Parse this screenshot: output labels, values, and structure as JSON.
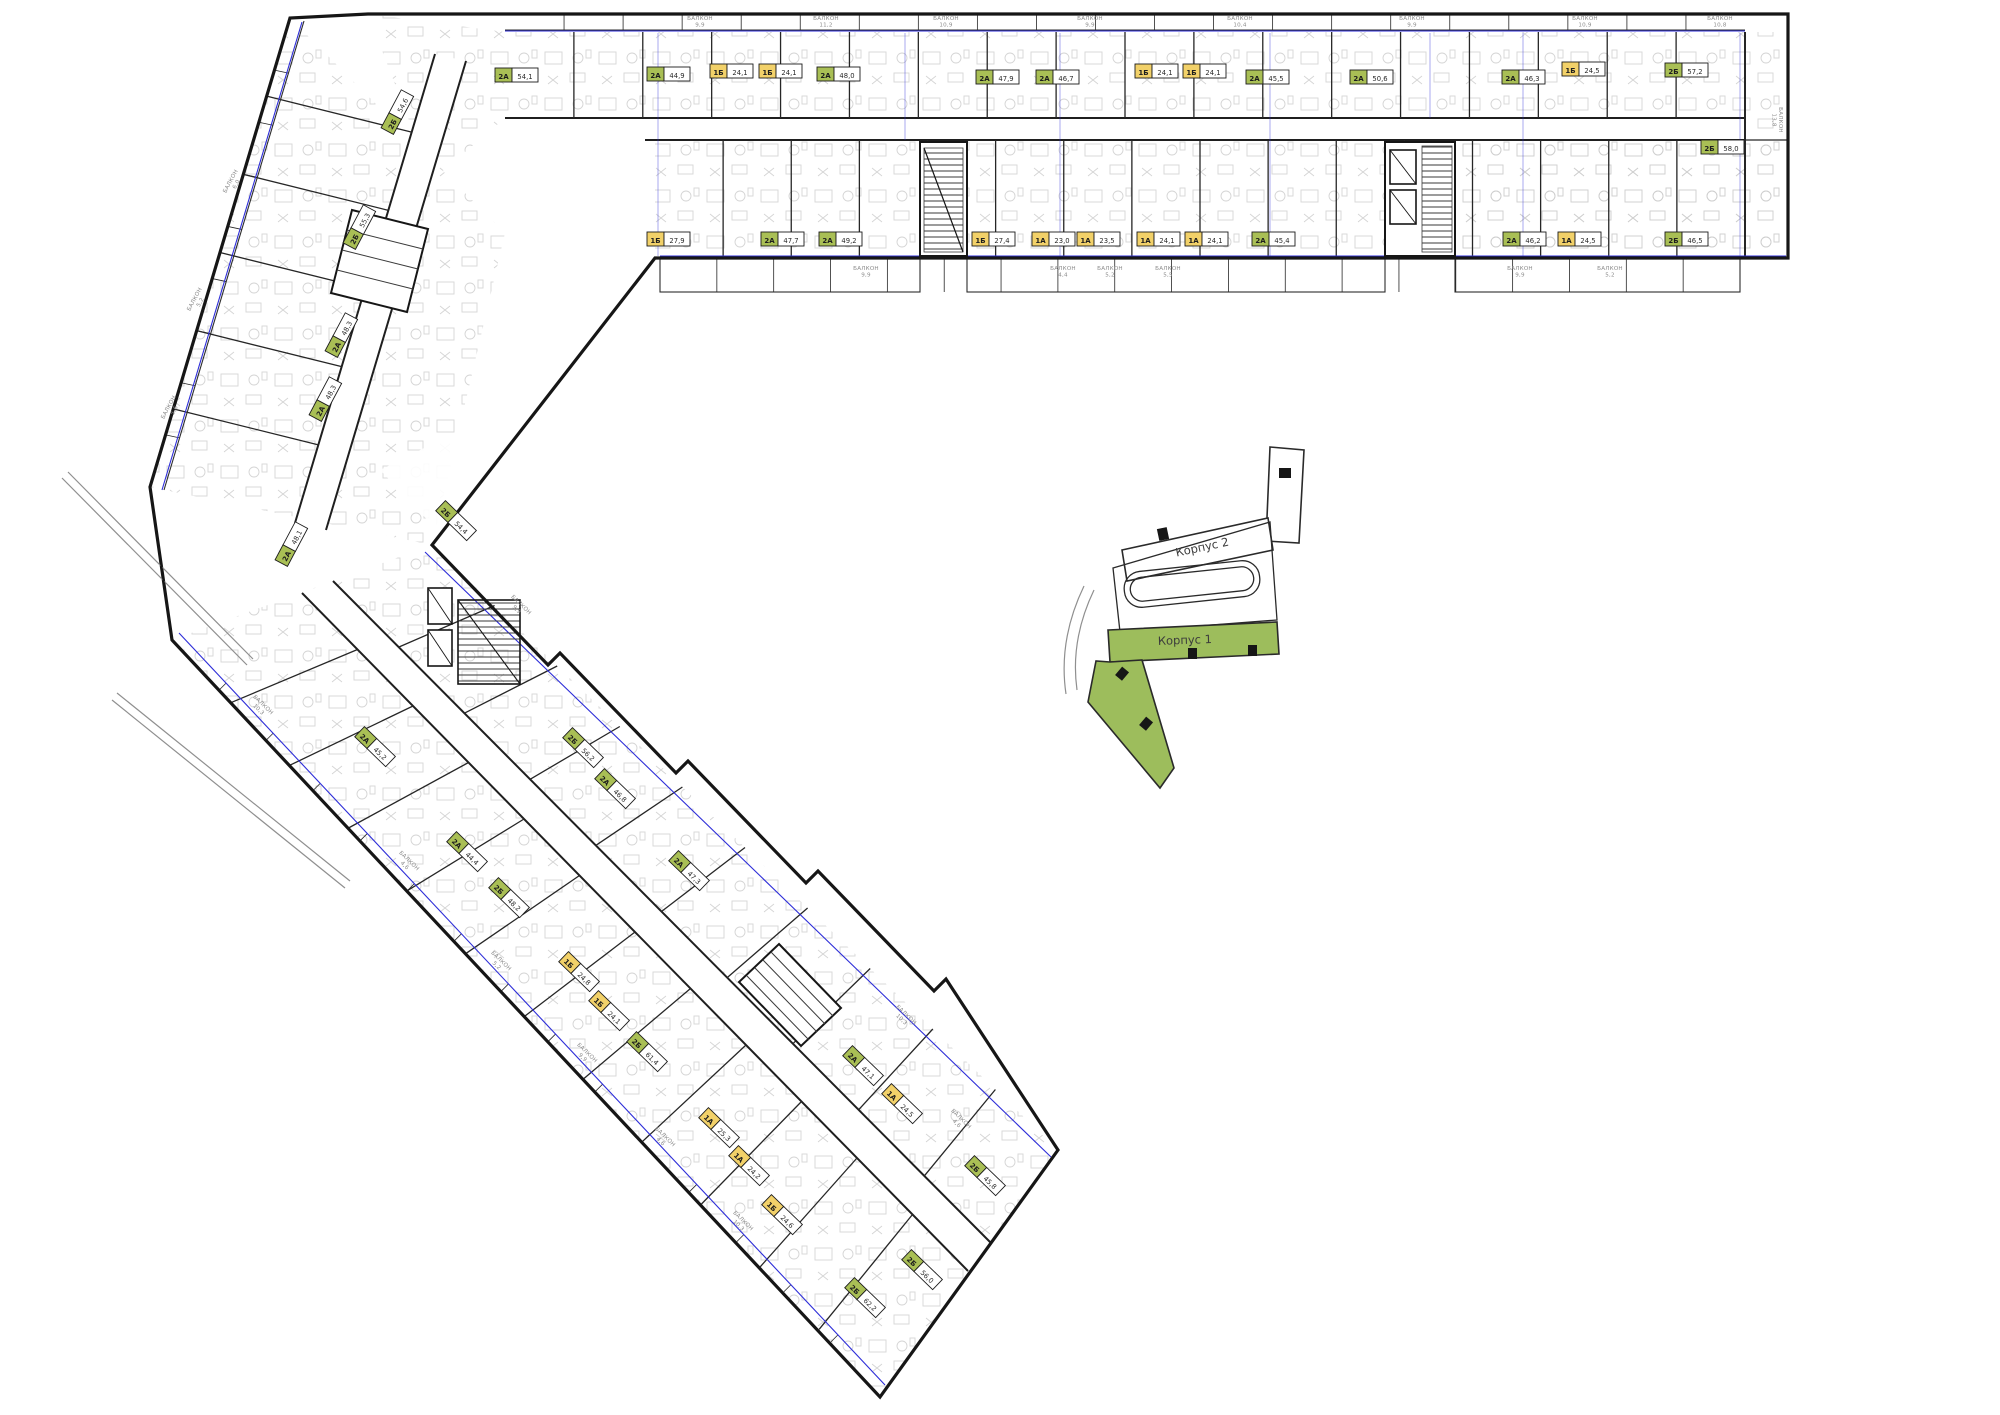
{
  "page": {
    "background": "#ffffff"
  },
  "colors": {
    "wall": "#161616",
    "detail_gray": "#9a9a9a",
    "window_blue": "#2d2dd8",
    "label_green": "#a9bf55",
    "label_yellow": "#f2d169",
    "label_border": "#1c1c1c",
    "keyplan_green": "#9dbd5c",
    "keyplan_wall": "#2a2a2a"
  },
  "key_plan": {
    "building1_label": "Корпус 1",
    "building2_label": "Корпус 2"
  },
  "plan": {
    "balcony_word": "БАЛКОН",
    "units": [
      {
        "t": "2А",
        "a": "54,1",
        "x": 516,
        "y": 76,
        "r": 0
      },
      {
        "t": "2А",
        "a": "44,9",
        "x": 668,
        "y": 75,
        "r": 0
      },
      {
        "t": "1Б",
        "a": "24,1",
        "x": 731,
        "y": 72,
        "r": 0
      },
      {
        "t": "1Б",
        "a": "24,1",
        "x": 780,
        "y": 72,
        "r": 0
      },
      {
        "t": "2А",
        "a": "48,0",
        "x": 838,
        "y": 75,
        "r": 0
      },
      {
        "t": "2А",
        "a": "47,9",
        "x": 997,
        "y": 78,
        "r": 0
      },
      {
        "t": "2А",
        "a": "46,7",
        "x": 1057,
        "y": 78,
        "r": 0
      },
      {
        "t": "1Б",
        "a": "24,1",
        "x": 1156,
        "y": 72,
        "r": 0
      },
      {
        "t": "1Б",
        "a": "24,1",
        "x": 1204,
        "y": 72,
        "r": 0
      },
      {
        "t": "2А",
        "a": "45,5",
        "x": 1267,
        "y": 78,
        "r": 0
      },
      {
        "t": "2А",
        "a": "50,6",
        "x": 1371,
        "y": 78,
        "r": 0
      },
      {
        "t": "2А",
        "a": "46,3",
        "x": 1523,
        "y": 78,
        "r": 0
      },
      {
        "t": "1Б",
        "a": "24,5",
        "x": 1583,
        "y": 70,
        "r": 0
      },
      {
        "t": "2Б",
        "a": "57,2",
        "x": 1686,
        "y": 71,
        "r": 0
      },
      {
        "t": "2Б",
        "a": "58,0",
        "x": 1722,
        "y": 148,
        "r": 0
      },
      {
        "t": "1Б",
        "a": "27,9",
        "x": 668,
        "y": 240,
        "r": 0
      },
      {
        "t": "2А",
        "a": "47,7",
        "x": 782,
        "y": 240,
        "r": 0
      },
      {
        "t": "2А",
        "a": "49,2",
        "x": 840,
        "y": 240,
        "r": 0
      },
      {
        "t": "1Б",
        "a": "27,4",
        "x": 993,
        "y": 240,
        "r": 0
      },
      {
        "t": "1А",
        "a": "23,0",
        "x": 1053,
        "y": 240,
        "r": 0
      },
      {
        "t": "1А",
        "a": "23,5",
        "x": 1098,
        "y": 240,
        "r": 0
      },
      {
        "t": "1А",
        "a": "24,1",
        "x": 1158,
        "y": 240,
        "r": 0
      },
      {
        "t": "1А",
        "a": "24,1",
        "x": 1206,
        "y": 240,
        "r": 0
      },
      {
        "t": "2А",
        "a": "45,4",
        "x": 1273,
        "y": 240,
        "r": 0
      },
      {
        "t": "2А",
        "a": "46,2",
        "x": 1524,
        "y": 240,
        "r": 0
      },
      {
        "t": "1А",
        "a": "24,5",
        "x": 1579,
        "y": 240,
        "r": 0
      },
      {
        "t": "2Б",
        "a": "46,5",
        "x": 1686,
        "y": 240,
        "r": 0
      },
      {
        "t": "2Б",
        "a": "54,6",
        "x": 398,
        "y": 113,
        "r": -62
      },
      {
        "t": "2Б",
        "a": "55,3",
        "x": 360,
        "y": 228,
        "r": -62
      },
      {
        "t": "2А",
        "a": "48,3",
        "x": 342,
        "y": 336,
        "r": -62
      },
      {
        "t": "2А",
        "a": "48,3",
        "x": 326,
        "y": 400,
        "r": -62
      },
      {
        "t": "2А",
        "a": "48,1",
        "x": 292,
        "y": 545,
        "r": -62
      },
      {
        "t": "2Б",
        "a": "54,4",
        "x": 455,
        "y": 521,
        "r": 44
      },
      {
        "t": "2Б",
        "a": "56,2",
        "x": 582,
        "y": 748,
        "r": 44
      },
      {
        "t": "2А",
        "a": "46,8",
        "x": 614,
        "y": 789,
        "r": 44
      },
      {
        "t": "2А",
        "a": "47,3",
        "x": 688,
        "y": 871,
        "r": 44
      },
      {
        "t": "2А",
        "a": "47,1",
        "x": 862,
        "y": 1066,
        "r": 44
      },
      {
        "t": "1А",
        "a": "24,5",
        "x": 901,
        "y": 1104,
        "r": 44
      },
      {
        "t": "2Б",
        "a": "45,8",
        "x": 984,
        "y": 1176,
        "r": 44
      },
      {
        "t": "2Б",
        "a": "56,0",
        "x": 921,
        "y": 1270,
        "r": 44
      },
      {
        "t": "2А",
        "a": "45,2",
        "x": 374,
        "y": 747,
        "r": 44
      },
      {
        "t": "2А",
        "a": "44,4",
        "x": 466,
        "y": 852,
        "r": 44
      },
      {
        "t": "2Б",
        "a": "48,2",
        "x": 508,
        "y": 898,
        "r": 44
      },
      {
        "t": "1Б",
        "a": "24,8",
        "x": 578,
        "y": 972,
        "r": 44
      },
      {
        "t": "1Б",
        "a": "24,1",
        "x": 608,
        "y": 1011,
        "r": 44
      },
      {
        "t": "2Б",
        "a": "61,4",
        "x": 646,
        "y": 1052,
        "r": 44
      },
      {
        "t": "1А",
        "a": "25,3",
        "x": 718,
        "y": 1128,
        "r": 44
      },
      {
        "t": "1А",
        "a": "24,2",
        "x": 748,
        "y": 1166,
        "r": 44
      },
      {
        "t": "1Б",
        "a": "24,6",
        "x": 781,
        "y": 1215,
        "r": 44
      },
      {
        "t": "2Б",
        "a": "62,2",
        "x": 864,
        "y": 1298,
        "r": 44
      }
    ],
    "balconies": [
      {
        "v": "9,9",
        "x": 700,
        "y": 20,
        "r": 0
      },
      {
        "v": "11,2",
        "x": 826,
        "y": 20,
        "r": 0
      },
      {
        "v": "10,9",
        "x": 946,
        "y": 20,
        "r": 0
      },
      {
        "v": "9,9",
        "x": 1090,
        "y": 20,
        "r": 0
      },
      {
        "v": "10,4",
        "x": 1240,
        "y": 20,
        "r": 0
      },
      {
        "v": "9,9",
        "x": 1412,
        "y": 20,
        "r": 0
      },
      {
        "v": "10,9",
        "x": 1585,
        "y": 20,
        "r": 0
      },
      {
        "v": "10,8",
        "x": 1720,
        "y": 20,
        "r": 0
      },
      {
        "v": "9,9",
        "x": 866,
        "y": 270,
        "r": 0
      },
      {
        "v": "4,4",
        "x": 1063,
        "y": 270,
        "r": 0
      },
      {
        "v": "5,2",
        "x": 1110,
        "y": 270,
        "r": 0
      },
      {
        "v": "5,5",
        "x": 1168,
        "y": 270,
        "r": 0
      },
      {
        "v": "9,9",
        "x": 1520,
        "y": 270,
        "r": 0
      },
      {
        "v": "5,2",
        "x": 1610,
        "y": 270,
        "r": 0
      },
      {
        "v": "13,8",
        "x": 1779,
        "y": 120,
        "r": 90
      },
      {
        "v": "6,0",
        "x": 232,
        "y": 182,
        "r": -62
      },
      {
        "v": "5,2",
        "x": 196,
        "y": 300,
        "r": -62
      },
      {
        "v": "5,6",
        "x": 170,
        "y": 408,
        "r": -62
      },
      {
        "v": "10,3",
        "x": 262,
        "y": 706,
        "r": 44
      },
      {
        "v": "4,6",
        "x": 408,
        "y": 862,
        "r": 44
      },
      {
        "v": "5,2",
        "x": 500,
        "y": 962,
        "r": 44
      },
      {
        "v": "9,9",
        "x": 586,
        "y": 1054,
        "r": 44
      },
      {
        "v": "4,6",
        "x": 664,
        "y": 1138,
        "r": 44
      },
      {
        "v": "10,3",
        "x": 742,
        "y": 1222,
        "r": 44
      },
      {
        "v": "9,9",
        "x": 520,
        "y": 606,
        "r": 44
      },
      {
        "v": "10,3",
        "x": 905,
        "y": 1016,
        "r": 44
      },
      {
        "v": "4,6",
        "x": 960,
        "y": 1120,
        "r": 44
      }
    ]
  }
}
